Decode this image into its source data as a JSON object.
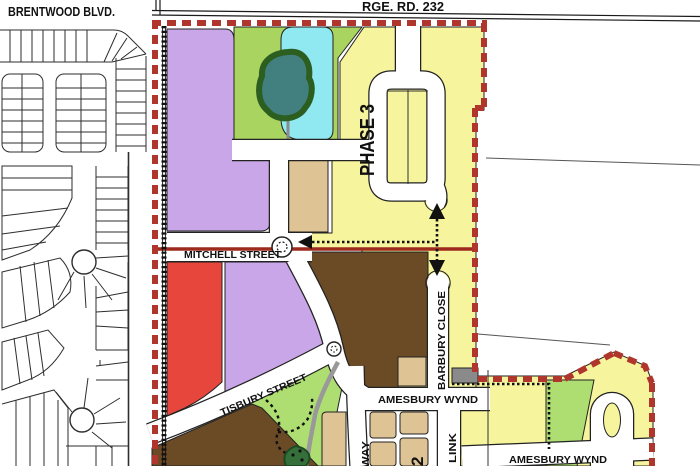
{
  "map_labels": {
    "brentwood_blvd": "BRENTWOOD BLVD.",
    "rge_rd_232": "RGE. RD. 232",
    "mitchell_street": "MITCHELL STREET",
    "tisbury_street": "TISBURY STREET",
    "barbury_close": "BARBURY CLOSE",
    "amesbury_wynd_1": "AMESBURY WYND",
    "amesbury_wynd_2": "AMESBURY WYND",
    "way_partial": "WAY",
    "link_partial": "LINK",
    "phase_3": "PHASE 3",
    "phase_2_partial": "2"
  },
  "colors": {
    "boundary_red": "#b0352c",
    "alignment_red_line": "#9e2a1e",
    "parcel_purple": "#c9a6e7",
    "parcel_green": "#a9d45f",
    "park_green": "#aede72",
    "parcel_cyan": "#90e8f0",
    "parcel_yellow": "#f7f49e",
    "parcel_tan": "#dec394",
    "parcel_brown": "#6b4a26",
    "parcel_red": "#e7463c",
    "pond_teal": "#41807f",
    "pond_ring_green": "#2c5e20",
    "phase_text_red": "#c1272d",
    "gray_path": "#999999",
    "road_outline": "#222222"
  }
}
